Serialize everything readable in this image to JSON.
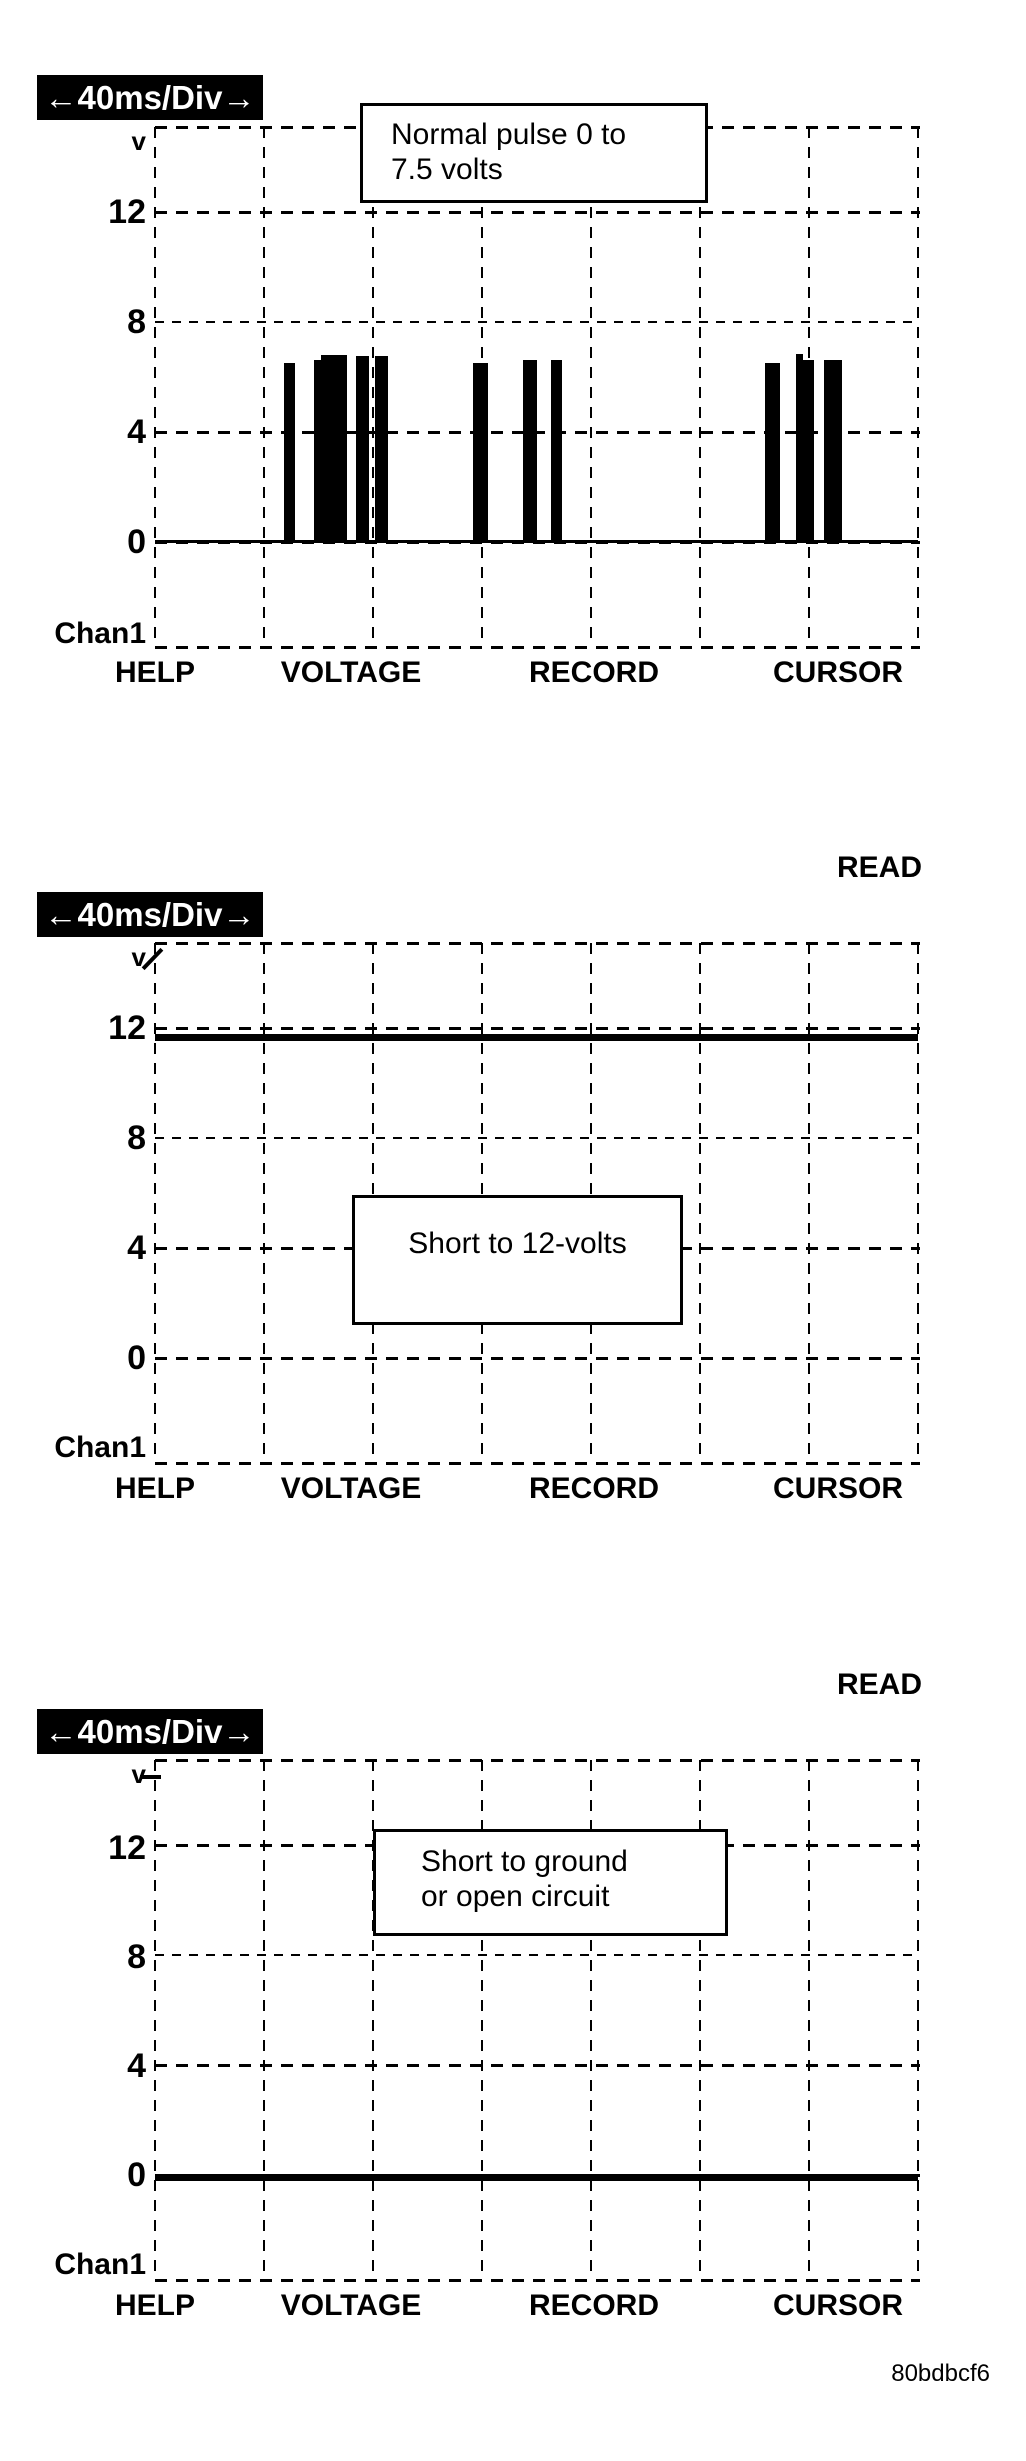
{
  "figure_code": "80bdbcf6",
  "read_label": "READ",
  "timebase": {
    "label": "←40ms/Div→"
  },
  "axis": {
    "v": "v",
    "t12": "12",
    "t8": "8",
    "t4": "4",
    "t0": "0",
    "channel": "Chan1"
  },
  "menu": {
    "items": [
      "HELP",
      "VOLTAGE",
      "RECORD",
      "CURSOR"
    ]
  },
  "colors": {
    "ink": "#000000",
    "paper": "#ffffff"
  },
  "panels": [
    {
      "name": "normal-pulse",
      "annotation": {
        "line1": "Normal pulse 0 to",
        "line2": "7.5 volts"
      },
      "pulses": [
        {
          "x_px": 284,
          "w_px": 11,
          "volts": 6.5
        },
        {
          "x_px": 314,
          "w_px": 7,
          "volts": 6.6
        },
        {
          "x_px": 321,
          "w_px": 26,
          "volts": 6.8
        },
        {
          "x_px": 356,
          "w_px": 13,
          "volts": 6.75
        },
        {
          "x_px": 375,
          "w_px": 13,
          "volts": 6.75
        },
        {
          "x_px": 473,
          "w_px": 15,
          "volts": 6.5
        },
        {
          "x_px": 523,
          "w_px": 14,
          "volts": 6.6
        },
        {
          "x_px": 551,
          "w_px": 11,
          "volts": 6.6
        },
        {
          "x_px": 765,
          "w_px": 15,
          "volts": 6.5
        },
        {
          "x_px": 796,
          "w_px": 7,
          "volts": 6.85
        },
        {
          "x_px": 803,
          "w_px": 11,
          "volts": 6.6
        },
        {
          "x_px": 824,
          "w_px": 18,
          "volts": 6.6
        }
      ]
    },
    {
      "name": "short-to-12v",
      "annotation": {
        "line1": "Short to 12-volts"
      }
    },
    {
      "name": "short-to-ground",
      "annotation": {
        "line1": "Short to ground",
        "line2": "or open circuit"
      }
    }
  ],
  "chart_data": [
    {
      "type": "line",
      "title": "Normal pulse 0 to 7.5 volts",
      "x_axis": {
        "label": "40ms/Div",
        "ms_per_div": 40,
        "divisions": 7,
        "range_ms": [
          0,
          280
        ]
      },
      "y_axis": {
        "label": "v",
        "ticks": [
          12,
          8,
          4,
          0
        ],
        "ylim": [
          -4,
          15
        ]
      },
      "grid": true,
      "channel": "Chan1",
      "baseline_v": 0,
      "pulses": [
        {
          "start_ms": 47,
          "end_ms": 51,
          "peak_v": 6.5
        },
        {
          "start_ms": 58,
          "end_ms": 70,
          "peak_v": 6.8
        },
        {
          "start_ms": 74,
          "end_ms": 79,
          "peak_v": 6.75
        },
        {
          "start_ms": 81,
          "end_ms": 86,
          "peak_v": 6.75
        },
        {
          "start_ms": 117,
          "end_ms": 122,
          "peak_v": 6.5
        },
        {
          "start_ms": 135,
          "end_ms": 140,
          "peak_v": 6.6
        },
        {
          "start_ms": 145,
          "end_ms": 149,
          "peak_v": 6.6
        },
        {
          "start_ms": 224,
          "end_ms": 229,
          "peak_v": 6.5
        },
        {
          "start_ms": 235,
          "end_ms": 242,
          "peak_v": 6.85
        },
        {
          "start_ms": 246,
          "end_ms": 252,
          "peak_v": 6.6
        }
      ],
      "footer_menu": [
        "HELP",
        "VOLTAGE",
        "RECORD",
        "CURSOR"
      ]
    },
    {
      "type": "line",
      "title": "Short to 12-volts",
      "status": "READ",
      "x_axis": {
        "label": "40ms/Div",
        "ms_per_div": 40,
        "divisions": 7,
        "range_ms": [
          0,
          280
        ]
      },
      "y_axis": {
        "label": "v",
        "ticks": [
          12,
          8,
          4,
          0
        ],
        "ylim": [
          -4,
          15
        ]
      },
      "grid": true,
      "channel": "Chan1",
      "trace": {
        "constant_v": 11.9
      },
      "footer_menu": [
        "HELP",
        "VOLTAGE",
        "RECORD",
        "CURSOR"
      ]
    },
    {
      "type": "line",
      "title": "Short to ground or open circuit",
      "status": "READ",
      "x_axis": {
        "label": "40ms/Div",
        "ms_per_div": 40,
        "divisions": 7,
        "range_ms": [
          0,
          280
        ]
      },
      "y_axis": {
        "label": "v",
        "ticks": [
          12,
          8,
          4,
          0
        ],
        "ylim": [
          -4,
          15
        ]
      },
      "grid": true,
      "channel": "Chan1",
      "trace": {
        "constant_v": 0
      },
      "footer_menu": [
        "HELP",
        "VOLTAGE",
        "RECORD",
        "CURSOR"
      ]
    }
  ]
}
